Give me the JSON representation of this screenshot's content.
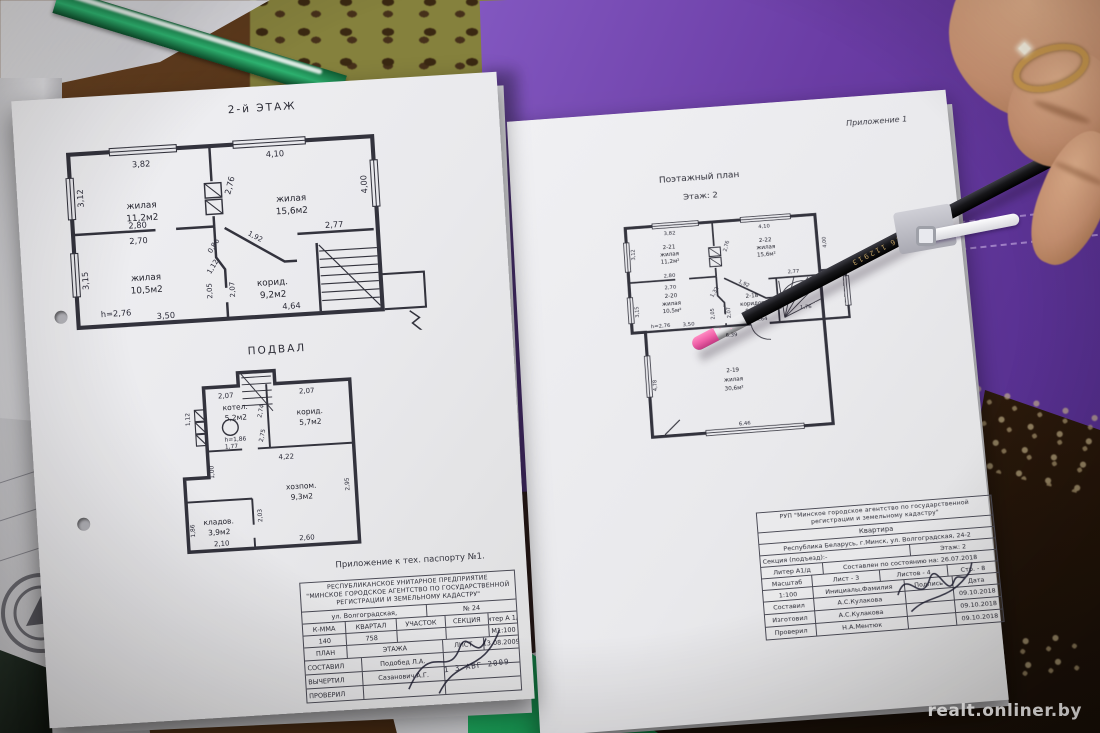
{
  "watermark": "realt.onliner.by",
  "pencil": {
    "marking": "090826 112913"
  },
  "side_papers": {
    "fragments": [
      "Минского го",
      "ток с ним и",
      "09600103,",
      "и исправлен",
      "жилого дом",
      "ного назнач"
    ]
  },
  "bottom_form": {
    "fragments": [
      "018",
      "№"
    ]
  },
  "left_page": {
    "floor2": {
      "title": "2-й ЭТАЖ",
      "rooms": [
        {
          "name": "жилая",
          "area": "11,2м2"
        },
        {
          "name": "жилая",
          "area": "15,6м2"
        },
        {
          "name": "жилая",
          "area": "10,5м2"
        },
        {
          "name": "корид.",
          "area": "9,2м2"
        }
      ],
      "dims": [
        "3,82",
        "4,10",
        "3,12",
        "2,76",
        "4,00",
        "2,80",
        "2,70",
        "0,86",
        "1,92",
        "2,77",
        "1,12",
        "2,05",
        "2,07",
        "3,15",
        "h=2,76",
        "3,50",
        "4,64"
      ]
    },
    "basement": {
      "title": "ПОДВАЛ",
      "rooms": [
        {
          "name": "котел.",
          "area": "5,2м2"
        },
        {
          "name": "корид.",
          "area": "5,7м2"
        },
        {
          "name": "хозпом.",
          "area": "9,3м2"
        },
        {
          "name": "кладов.",
          "area": "3,9м2"
        }
      ],
      "dims": [
        "2,07",
        "2,07",
        "1,12",
        "2,74",
        "2,75",
        "h=1,86",
        "1,77",
        "4,22",
        "1,00",
        "2,95",
        "2,03",
        "2,60",
        "1,86",
        "2,10"
      ]
    },
    "appendix_note": "Приложение к тех. паспорту №1.",
    "title_block": {
      "org1": "РЕСПУБЛИКАНСКОЕ УНИТАРНОЕ ПРЕДПРИЯТИЕ",
      "org2": "\"МИНСКОЕ ГОРОДСКОЕ АГЕНТСТВО ПО ГОСУДАРСТВЕННОЙ",
      "org3": "РЕГИСТРАЦИИ И ЗЕМЕЛЬНОМУ КАДАСТРУ\"",
      "street": "ул. Волгоградская,",
      "number": "№ 24",
      "col_headers": [
        "К-ММА",
        "КВАРТАЛ",
        "УЧАСТОК",
        "СЕКЦИЯ"
      ],
      "liter": "литер А 1/д",
      "values": [
        "140",
        "758"
      ],
      "scale": "М1:100",
      "plan_label": "ПЛАН",
      "etazha": "ЭТАЖА",
      "list_label": "ЛИСТ",
      "date": "13.08.2009",
      "stamp_date": "1 3 АВГ 2009",
      "roles": [
        {
          "label": "СОСТАВИЛ",
          "name": "Подобед Л.А."
        },
        {
          "label": "ВЫЧЕРТИЛ",
          "name": "Сазанович А.Г."
        },
        {
          "label": "ПРОВЕРИЛ",
          "name": ""
        }
      ]
    }
  },
  "right_page": {
    "appendix": "Приложение 1",
    "title": "Поэтажный план",
    "subtitle": "Этаж: 2",
    "plan": {
      "rooms": [
        {
          "code": "2-21",
          "name": "жилая",
          "area": "11,2м²"
        },
        {
          "code": "2-22",
          "name": "жилая",
          "area": "15,6м²"
        },
        {
          "code": "2-20",
          "name": "жилая",
          "area": "10,5м²"
        },
        {
          "code": "2-18",
          "name": "коридор",
          "area": "9,6м²"
        },
        {
          "code": "2-19",
          "name": "жилая",
          "area": "30,6м²"
        }
      ],
      "dims": [
        "3,82",
        "4,10",
        "3,12",
        "2,76",
        "4,00",
        "2,80",
        "2,70",
        "1,32",
        "1,92",
        "2,77",
        "2,05",
        "2,07",
        "3,15",
        "h=2,76",
        "3,50",
        "4,64",
        "1,76",
        "6,39",
        "4,78",
        "6,46"
      ]
    },
    "title_block": {
      "org1": "РУП \"Минское городское агентство по государственной",
      "org2": "регистрации и земельному кадастру\"",
      "type": "Квартира",
      "address": "Республика Беларусь, г.Минск, ул. Волгоградская, 24-2",
      "section": "Секция (подъезд):-",
      "floor": "Этаж: 2",
      "liter": "Литер А1/д",
      "compiled": "Составлен по состоянию на: 26.07.2018",
      "scale_label": "Масштаб",
      "sheet": "Лист - 3",
      "sheets": "Листов - 4",
      "page": "Стр. - 8",
      "scale": "1:100",
      "name_header": "Инициалы,Фамилия",
      "sign_header": "Подпись",
      "date_header": "Дата",
      "roles": [
        {
          "label": "Составил",
          "name": "А.С.Кулакова",
          "date": "09.10.2018"
        },
        {
          "label": "Изготовил",
          "name": "А.С.Кулакова",
          "date": "09.10.2018"
        },
        {
          "label": "Проверил",
          "name": "Н.А.Ментюк",
          "date": "09.10.2018"
        }
      ]
    }
  }
}
